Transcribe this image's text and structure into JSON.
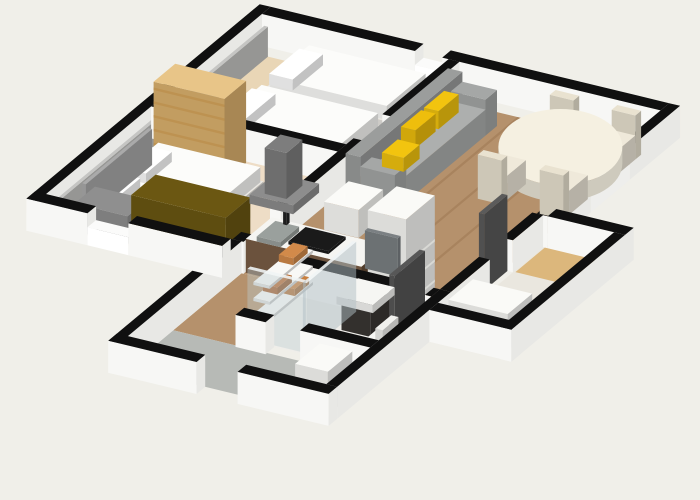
{
  "canvas": {
    "width": 700,
    "height": 500,
    "background": "#f0efe9"
  },
  "projection": {
    "ox": 262,
    "oy": 46,
    "ux": [
      0.91,
      0.22
    ],
    "uy": [
      -0.72,
      0.6
    ],
    "wall_height": 32
  },
  "palette": {
    "background": "#f0efe9",
    "wall_cap": "#101010",
    "wall_face": "#f7f7f5",
    "wall_face_shade": "#e8e8e5",
    "bedroom_floor": "#e9d6b6",
    "living_floor": "#b5916c",
    "tile_floor": "#b7bab6",
    "bath_floor": "#efeeea",
    "wood_furniture": "#ddb26e",
    "sofa_gray": "#a5a7a6",
    "cushion_yellow": "#f2c40f",
    "counter_wood": "#6b523d",
    "towel_orange": "#c97f3e"
  },
  "scene": {
    "type": "3d-floor-plan",
    "rooms": [
      {
        "name": "bedroom-2",
        "floor": "light-wood",
        "furniture": [
          "single-bed-1",
          "single-bed-2",
          "gray-accent-panel"
        ]
      },
      {
        "name": "bedroom-1",
        "floor": "light-wood",
        "furniture": [
          "double-bed",
          "headboard",
          "bookshelf",
          "desk",
          "olive-desk-panel"
        ]
      },
      {
        "name": "living-dining",
        "floor": "brown-wood-planks",
        "furniture": [
          "gray-sofa",
          "yellow-cushions-x3",
          "oval-dining-table",
          "dining-chairs-x4"
        ]
      },
      {
        "name": "kitchen",
        "floor": "brown-wood-planks",
        "furniture": [
          "island-counter",
          "sink",
          "faucet",
          "cooktop",
          "extractor-hood",
          "wall-cabinet",
          "fridge"
        ]
      },
      {
        "name": "bathroom",
        "floor": "white-tile",
        "furniture": [
          "glass-shower",
          "towel-shelf",
          "vanity-sink",
          "mirror",
          "toilet",
          "open-door"
        ]
      },
      {
        "name": "entry-hall",
        "floor": "gray-tile",
        "furniture": [
          "white-cabinet"
        ]
      },
      {
        "name": "side-hall",
        "floor": "pale",
        "furniture": [
          "tan-mat",
          "white-cabinet"
        ]
      }
    ]
  },
  "objects": [
    {
      "name": "bedroom2-floor",
      "x0": 12,
      "y0": 12,
      "x1": 205,
      "y1": 142,
      "h": 0,
      "c": "#e9d6b6"
    },
    {
      "name": "bedroom1-floor",
      "x0": 12,
      "y0": 154,
      "x1": 205,
      "y1": 300,
      "h": 0,
      "c": "#eeddc6"
    },
    {
      "name": "living-room-floor",
      "x0": 215,
      "y0": 12,
      "x1": 435,
      "y1": 300,
      "h": 0,
      "c": "#b5916c"
    },
    {
      "name": "floor-plank-1",
      "x0": 252,
      "y0": 12,
      "x1": 255,
      "y1": 300,
      "h": 0,
      "c": "#a8835e"
    },
    {
      "name": "floor-plank-2",
      "x0": 290,
      "y0": 12,
      "x1": 293,
      "y1": 300,
      "h": 0,
      "c": "#a8835e"
    },
    {
      "name": "floor-plank-3",
      "x0": 328,
      "y0": 12,
      "x1": 331,
      "y1": 300,
      "h": 0,
      "c": "#a8835e"
    },
    {
      "name": "floor-plank-4",
      "x0": 366,
      "y0": 12,
      "x1": 369,
      "y1": 300,
      "h": 0,
      "c": "#a8835e"
    },
    {
      "name": "floor-plank-5",
      "x0": 404,
      "y0": 12,
      "x1": 407,
      "y1": 300,
      "h": 0,
      "c": "#a8835e"
    },
    {
      "name": "corridor-floor",
      "x0": 215,
      "y0": 300,
      "x1": 285,
      "y1": 395,
      "h": 0,
      "c": "#b5916c"
    },
    {
      "name": "bathroom-floor",
      "x0": 285,
      "y0": 312,
      "x1": 433,
      "y1": 385,
      "h": 0,
      "c": "#efeeea"
    },
    {
      "name": "entry-floor",
      "x0": 215,
      "y0": 395,
      "x1": 433,
      "y1": 458,
      "h": 0,
      "c": "#b7bab6"
    },
    {
      "name": "hall-floor",
      "x0": 445,
      "y0": 165,
      "x1": 523,
      "y1": 330,
      "h": 0,
      "c": "#eae7df"
    },
    {
      "name": "hall-mat",
      "x0": 447,
      "y0": 167,
      "x1": 521,
      "y1": 213,
      "h": 0,
      "c": "#dcb77c"
    },
    {
      "name": "outer-wall-nw",
      "x0": -12,
      "y0": -12,
      "x1": 0,
      "y1": 312,
      "h": 32,
      "wall": true
    },
    {
      "name": "outer-wall-n-a",
      "x0": 0,
      "y0": -12,
      "x1": 168,
      "y1": 0,
      "h": 32,
      "wall": true
    },
    {
      "name": "window-sill-n",
      "x0": 168,
      "y0": -12,
      "x1": 198,
      "y1": 0,
      "h": 18,
      "sill": true
    },
    {
      "name": "outer-wall-n-b",
      "x0": 198,
      "y0": -12,
      "x1": 438,
      "y1": 0,
      "h": 32,
      "wall": true
    },
    {
      "name": "outer-wall-ne-a",
      "x0": 438,
      "y0": -12,
      "x1": 450,
      "y1": 58,
      "h": 32,
      "wall": true
    },
    {
      "name": "window-sill-ne",
      "x0": 438,
      "y0": 58,
      "x1": 450,
      "y1": 112,
      "h": 18,
      "sill": true
    },
    {
      "name": "outer-wall-ne-b",
      "x0": 438,
      "y0": 112,
      "x1": 450,
      "y1": 172,
      "h": 32,
      "wall": true
    },
    {
      "name": "accent-panel-bedroom2",
      "x0": 12,
      "y0": 12,
      "x1": 16,
      "y1": 140,
      "h": 30,
      "c": "#c5c5c3"
    },
    {
      "name": "accent-panel-bedroom1",
      "x0": 12,
      "y0": 154,
      "x1": 16,
      "y1": 298,
      "h": 30,
      "c": "#c5c5c3"
    },
    {
      "name": "single-bed-1-base",
      "x0": 58,
      "y0": 16,
      "x1": 196,
      "y1": 74,
      "h": 12,
      "c": "#e9e7e2"
    },
    {
      "name": "single-bed-1-duvet",
      "x0": 66,
      "y0": 18,
      "x1": 194,
      "y1": 72,
      "z0": 12,
      "h": 14,
      "c": "#fcfcfa"
    },
    {
      "name": "single-bed-1-pillow",
      "x0": 60,
      "y0": 24,
      "x1": 86,
      "y1": 66,
      "z0": 14,
      "h": 11,
      "c": "#ffffff"
    },
    {
      "name": "single-bed-2-base",
      "x0": 58,
      "y0": 82,
      "x1": 196,
      "y1": 140,
      "h": 12,
      "c": "#e9e7e2"
    },
    {
      "name": "single-bed-2-duvet",
      "x0": 66,
      "y0": 84,
      "x1": 194,
      "y1": 138,
      "z0": 12,
      "h": 14,
      "c": "#fcfcfa"
    },
    {
      "name": "single-bed-2-pillow",
      "x0": 60,
      "y0": 90,
      "x1": 86,
      "y1": 132,
      "z0": 14,
      "h": 11,
      "c": "#ffffff"
    },
    {
      "name": "bedrooms-divider-wall",
      "x0": 0,
      "y0": 142,
      "x1": 205,
      "y1": 154,
      "h": 32,
      "wall": true
    },
    {
      "name": "bookshelf",
      "x0": 28,
      "y0": 156,
      "x1": 106,
      "y1": 186,
      "h": 82,
      "c": "#ddb26e",
      "top": "#e8c588",
      "slatsY": {
        "n": 6,
        "color": "#bd9251",
        "from": 0.06,
        "to": 0.9
      }
    },
    {
      "name": "double-bed-base",
      "x0": 28,
      "y0": 190,
      "x1": 152,
      "y1": 280,
      "h": 12,
      "c": "#e9e7e2"
    },
    {
      "name": "double-bed-duvet",
      "x0": 38,
      "y0": 192,
      "x1": 150,
      "y1": 278,
      "z0": 12,
      "h": 15,
      "c": "#fcfcfa"
    },
    {
      "name": "double-bed-pillow-1",
      "x0": 30,
      "y0": 196,
      "x1": 56,
      "y1": 232,
      "z0": 14,
      "h": 10,
      "c": "#ffffff"
    },
    {
      "name": "double-bed-pillow-2",
      "x0": 30,
      "y0": 240,
      "x1": 56,
      "y1": 276,
      "z0": 14,
      "h": 10,
      "c": "#ffffff"
    },
    {
      "name": "double-bed-headboard",
      "x0": 24,
      "y0": 188,
      "x1": 28,
      "y1": 280,
      "h": 36,
      "c": "#aaaaaa"
    },
    {
      "name": "desk",
      "x0": 30,
      "y0": 270,
      "x1": 88,
      "y1": 298,
      "h": 28,
      "c": "#8f8f8f"
    },
    {
      "name": "desk-panel",
      "x0": 92,
      "y0": 264,
      "x1": 196,
      "y1": 298,
      "h": 50,
      "c": "#6b5712"
    },
    {
      "name": "bedrooms-east-wall-a",
      "x0": 205,
      "y0": 0,
      "x1": 217,
      "y1": 92,
      "h": 32,
      "wall": true
    },
    {
      "name": "bedrooms-east-wall-b",
      "x0": 205,
      "y0": 132,
      "x1": 217,
      "y1": 248,
      "h": 32,
      "wall": true
    },
    {
      "name": "bedrooms-east-wall-c",
      "x0": 205,
      "y0": 288,
      "x1": 217,
      "y1": 300,
      "h": 32,
      "wall": true
    },
    {
      "name": "sofa-back",
      "x0": 228,
      "y0": 30,
      "x1": 244,
      "y1": 172,
      "h": 46,
      "c": "#9b9d9c"
    },
    {
      "name": "sofa-arm-1",
      "x0": 244,
      "y0": 30,
      "x1": 282,
      "y1": 46,
      "h": 36,
      "c": "#a5a7a6"
    },
    {
      "name": "sofa-seat",
      "x0": 244,
      "y0": 46,
      "x1": 282,
      "y1": 156,
      "h": 26,
      "c": "#adafae"
    },
    {
      "name": "sofa-arm-2",
      "x0": 244,
      "y0": 156,
      "x1": 282,
      "y1": 172,
      "h": 36,
      "c": "#a5a7a6"
    },
    {
      "name": "sofa-cushion-1",
      "x0": 246,
      "y0": 58,
      "x1": 262,
      "y1": 86,
      "z0": 26,
      "h": 18,
      "c": "#f2c40f"
    },
    {
      "name": "sofa-cushion-2",
      "x0": 246,
      "y0": 90,
      "x1": 262,
      "y1": 118,
      "z0": 26,
      "h": 18,
      "c": "#eebe0c"
    },
    {
      "name": "sofa-cushion-3",
      "x0": 252,
      "y0": 130,
      "x1": 276,
      "y1": 152,
      "z0": 26,
      "h": 14,
      "c": "#f2c40f"
    },
    {
      "name": "dining-chair-1-back",
      "x0": 340,
      "y0": 22,
      "x1": 366,
      "y1": 30,
      "h": 44,
      "c": "#e9e2d0"
    },
    {
      "name": "dining-chair-1-seat",
      "x0": 340,
      "y0": 30,
      "x1": 366,
      "y1": 56,
      "h": 24,
      "c": "#efe9da"
    },
    {
      "name": "dining-chair-2-back",
      "x0": 408,
      "y0": 22,
      "x1": 434,
      "y1": 30,
      "h": 44,
      "c": "#e9e2d0"
    },
    {
      "name": "dining-chair-2-seat",
      "x0": 408,
      "y0": 30,
      "x1": 434,
      "y1": 56,
      "h": 24,
      "c": "#efe9da"
    },
    {
      "name": "dining-table",
      "type": "table",
      "cx": 388,
      "cy": 76,
      "rxs": 62,
      "rys": 38,
      "h": 30,
      "c": "#f5f0e1"
    },
    {
      "name": "dining-chair-3-seat",
      "x0": 340,
      "y0": 96,
      "x1": 366,
      "y1": 122,
      "h": 24,
      "c": "#efe9da"
    },
    {
      "name": "dining-chair-3-back",
      "x0": 340,
      "y0": 122,
      "x1": 366,
      "y1": 130,
      "h": 44,
      "c": "#e9e2d0"
    },
    {
      "name": "dining-chair-4-seat",
      "x0": 408,
      "y0": 96,
      "x1": 434,
      "y1": 122,
      "h": 24,
      "c": "#efe9da"
    },
    {
      "name": "dining-chair-4-back",
      "x0": 408,
      "y0": 122,
      "x1": 434,
      "y1": 130,
      "h": 44,
      "c": "#e9e2d0"
    },
    {
      "name": "kitchen-counter",
      "x0": 218,
      "y0": 262,
      "x1": 345,
      "y1": 298,
      "h": 34,
      "top": "#f5f5f2",
      "sy": "#6b523d",
      "sx": "#503c2b"
    },
    {
      "name": "kitchen-sink",
      "x0": 226,
      "y0": 267,
      "x1": 252,
      "y1": 293,
      "z0": 30,
      "h": 5,
      "c": "#9aa09d"
    },
    {
      "name": "kitchen-faucet",
      "x0": 236,
      "y0": 265,
      "x1": 240,
      "y1": 269,
      "z0": 35,
      "h": 13,
      "c": "#222222"
    },
    {
      "name": "cooktop",
      "x0": 260,
      "y0": 268,
      "x1": 304,
      "y1": 292,
      "z0": 34,
      "h": 3,
      "c": "#1a1a1a"
    },
    {
      "name": "hood-canopy",
      "x0": 222,
      "y0": 262,
      "x1": 270,
      "y1": 298,
      "z0": 70,
      "h": 9,
      "c": "#8d8d8d"
    },
    {
      "name": "hood-chimney",
      "x0": 234,
      "y0": 270,
      "x1": 258,
      "y1": 292,
      "z0": 79,
      "h": 46,
      "c": "#7d7d7d"
    },
    {
      "name": "kitchen-wall-cabinet",
      "x0": 304,
      "y0": 264,
      "x1": 342,
      "y1": 298,
      "z0": 62,
      "h": 28,
      "c": "#fbfbf8"
    },
    {
      "name": "fridge",
      "x0": 352,
      "y0": 258,
      "x1": 394,
      "y1": 298,
      "h": 92,
      "c": "#fafaf7",
      "slatsX": {
        "n": 3,
        "color": "#d9d9d5",
        "from": 0.06,
        "to": 0.5
      }
    },
    {
      "name": "bathroom-north-wall",
      "x0": 285,
      "y0": 300,
      "x1": 394,
      "y1": 312,
      "h": 32,
      "wall": true
    },
    {
      "name": "bathroom-north-wall-b",
      "x0": 426,
      "y0": 300,
      "x1": 433,
      "y1": 312,
      "h": 32,
      "wall": true
    },
    {
      "name": "block-west-wall",
      "x0": 203,
      "y0": 300,
      "x1": 215,
      "y1": 470,
      "h": 32,
      "wall": true
    },
    {
      "name": "bathroom-mirror",
      "x0": 356,
      "y0": 303,
      "x1": 392,
      "y1": 307,
      "z0": 40,
      "h": 38,
      "c": "#7b8083"
    },
    {
      "name": "bathroom-door",
      "x0": 420,
      "y0": 312,
      "x1": 426,
      "y1": 354,
      "h": 76,
      "c": "#575757"
    },
    {
      "name": "vanity-cabinet",
      "x0": 358,
      "y0": 316,
      "x1": 390,
      "y1": 342,
      "h": 26,
      "c": "#3a3633"
    },
    {
      "name": "bathroom-basin",
      "x0": 354,
      "y0": 314,
      "x1": 394,
      "y1": 344,
      "z0": 26,
      "h": 8,
      "c": "#f6f6f3"
    },
    {
      "name": "shower-shelf-1",
      "x0": 288,
      "y0": 316,
      "x1": 306,
      "y1": 376,
      "z0": 18,
      "h": 3,
      "c": "#f8f8f6"
    },
    {
      "name": "towel-1",
      "x0": 289,
      "y0": 320,
      "x1": 305,
      "y1": 340,
      "z0": 21,
      "h": 7,
      "c": "#c97f3e"
    },
    {
      "name": "shower-shelf-2",
      "x0": 288,
      "y0": 316,
      "x1": 306,
      "y1": 376,
      "z0": 34,
      "h": 3,
      "c": "#f8f8f6"
    },
    {
      "name": "towel-2",
      "x0": 289,
      "y0": 344,
      "x1": 305,
      "y1": 364,
      "z0": 37,
      "h": 7,
      "c": "#b96a30"
    },
    {
      "name": "shower-shelf-3",
      "x0": 288,
      "y0": 316,
      "x1": 306,
      "y1": 376,
      "z0": 50,
      "h": 3,
      "c": "#f8f8f6"
    },
    {
      "name": "towel-3",
      "x0": 289,
      "y0": 322,
      "x1": 305,
      "y1": 342,
      "z0": 53,
      "h": 7,
      "c": "#d28a4a"
    },
    {
      "name": "toilet",
      "x0": 408,
      "y0": 352,
      "x1": 430,
      "y1": 378,
      "h": 20,
      "c": "#f7f7f4"
    },
    {
      "name": "toilet-tank",
      "x0": 422,
      "y0": 354,
      "x1": 430,
      "y1": 376,
      "z0": 20,
      "h": 16,
      "c": "#f1f1ee"
    },
    {
      "name": "shower-glass-side",
      "x0": 348,
      "y0": 314,
      "x1": 352,
      "y1": 383,
      "h": 70,
      "top": "rgba(240,244,245,0.9)",
      "sy": "rgba(190,205,210,0.4)",
      "sx": "rgba(175,190,196,0.5)"
    },
    {
      "name": "shower-glass-front",
      "x0": 287,
      "y0": 379,
      "x1": 348,
      "y1": 383,
      "h": 70,
      "top": "rgba(240,244,245,0.9)",
      "sy": "rgba(190,205,210,0.4)",
      "sx": "rgba(175,190,196,0.5)"
    },
    {
      "name": "bathroom-south-wall-a",
      "x0": 285,
      "y0": 385,
      "x1": 318,
      "y1": 397,
      "h": 32,
      "wall": true
    },
    {
      "name": "bathroom-south-wall-b",
      "x0": 356,
      "y0": 385,
      "x1": 433,
      "y1": 397,
      "h": 32,
      "wall": true
    },
    {
      "name": "entry-cabinet",
      "x0": 394,
      "y0": 418,
      "x1": 430,
      "y1": 452,
      "h": 40,
      "c": "#fafaf7"
    },
    {
      "name": "living-east-wall-a",
      "x0": 433,
      "y0": 172,
      "x1": 445,
      "y1": 214,
      "h": 32,
      "wall": true
    },
    {
      "name": "hall-door",
      "x0": 433,
      "y0": 214,
      "x1": 439,
      "y1": 246,
      "h": 76,
      "c": "#5b5b5b"
    },
    {
      "name": "living-east-wall-b",
      "x0": 433,
      "y0": 246,
      "x1": 445,
      "y1": 300,
      "h": 32,
      "wall": true
    },
    {
      "name": "bath-east-wall",
      "x0": 433,
      "y0": 300,
      "x1": 445,
      "y1": 458,
      "h": 32,
      "wall": true
    },
    {
      "name": "entry-south-wall-a",
      "x0": 203,
      "y0": 458,
      "x1": 300,
      "y1": 470,
      "h": 32,
      "wall": true
    },
    {
      "name": "entry-south-wall-b",
      "x0": 345,
      "y0": 458,
      "x1": 445,
      "y1": 470,
      "h": 32,
      "wall": true
    },
    {
      "name": "sw-outer-wall-a",
      "x0": -12,
      "y0": 300,
      "x1": 55,
      "y1": 312,
      "h": 32,
      "wall": true
    },
    {
      "name": "sw-window-sill",
      "x0": 55,
      "y0": 300,
      "x1": 100,
      "y1": 312,
      "h": 18,
      "sill": true
    },
    {
      "name": "sw-outer-wall-b",
      "x0": 100,
      "y0": 300,
      "x1": 203,
      "y1": 312,
      "h": 32,
      "wall": true
    },
    {
      "name": "hall-north-wall",
      "x0": 450,
      "y0": 160,
      "x1": 535,
      "y1": 172,
      "h": 32,
      "wall": true
    },
    {
      "name": "hall-cabinet",
      "x0": 455,
      "y0": 282,
      "x1": 520,
      "y1": 316,
      "h": 36,
      "c": "#fafaf7"
    },
    {
      "name": "hall-east-wall",
      "x0": 523,
      "y0": 172,
      "x1": 535,
      "y1": 330,
      "h": 32,
      "wall": true
    },
    {
      "name": "hall-south-wall",
      "x0": 445,
      "y0": 318,
      "x1": 535,
      "y1": 330,
      "h": 32,
      "wall": true
    }
  ]
}
